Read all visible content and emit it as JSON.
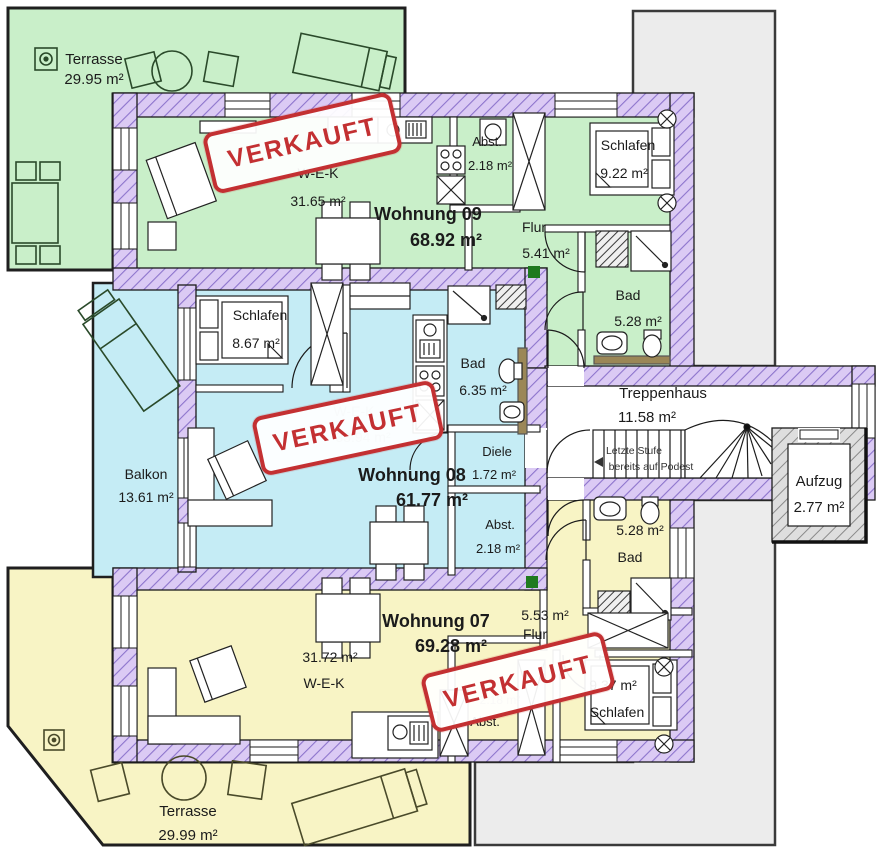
{
  "stamp": {
    "label": "VERKAUFT"
  },
  "colors": {
    "apartment_green": "#c9efc9",
    "apartment_blue": "#c5ecf5",
    "apartment_yellow": "#f8f4c5",
    "wall_lavender": "#dbcaf4",
    "wall_hatch_line": "#8d74cc",
    "stamp_red": "#c33032",
    "neighbor_gray": "#ececec",
    "marker_green": "#1f7a1f"
  },
  "apartments": [
    {
      "id": "wohnung09",
      "title": "Wohnung 09",
      "area": "68.92 m²",
      "status": "VERKAUFT"
    },
    {
      "id": "wohnung08",
      "title": "Wohnung 08",
      "area": "61.77 m²",
      "status": "VERKAUFT"
    },
    {
      "id": "wohnung07",
      "title": "Wohnung 07",
      "area": "69.28 m²",
      "status": "VERKAUFT"
    }
  ],
  "rooms": {
    "terrasse_nord": {
      "name": "Terrasse",
      "area": "29.95 m²"
    },
    "wek09": {
      "name": "W-E-K",
      "area": "31.65 m²"
    },
    "abst09": {
      "name": "Abst.",
      "area": "2.18 m²"
    },
    "flur09": {
      "name": "Flur",
      "area": "5.41 m²"
    },
    "schlafen09": {
      "name": "Schlafen",
      "area": "9.22 m²"
    },
    "bad09": {
      "name": "Bad",
      "area": "5.28 m²"
    },
    "schlafen08": {
      "name": "Schlafen",
      "area": "8.67 m²"
    },
    "bad08": {
      "name": "Bad",
      "area": "6.35 m²"
    },
    "wek08": {
      "name": "W-E-K",
      "area": "33.94 m²"
    },
    "diele08": {
      "name": "Diele",
      "area": "1.72 m²"
    },
    "abst08": {
      "name": "Abst.",
      "area": "2.18 m²"
    },
    "balkon": {
      "name": "Balkon",
      "area": "13.61 m²"
    },
    "treppenhaus": {
      "name": "Treppenhaus",
      "area": "11.58 m²"
    },
    "aufzug": {
      "name": "Aufzug",
      "area": "2.77 m²"
    },
    "flur07": {
      "name": "Flur",
      "area": "5.53 m²"
    },
    "bad07": {
      "name": "Bad",
      "area": "5.28 m²"
    },
    "wek07": {
      "name": "W-E-K",
      "area": "31.72 m²"
    },
    "abst07": {
      "name": "Abst.",
      "area": "2.18 m²"
    },
    "schlafen07": {
      "name": "Schlafen",
      "area": "9.37 m²"
    },
    "terrasse_sued": {
      "name": "Terrasse",
      "area": "29.99 m²"
    }
  },
  "notes": {
    "stair_line1": "Letzte Stufe",
    "stair_line2": "bereits auf Podest"
  }
}
